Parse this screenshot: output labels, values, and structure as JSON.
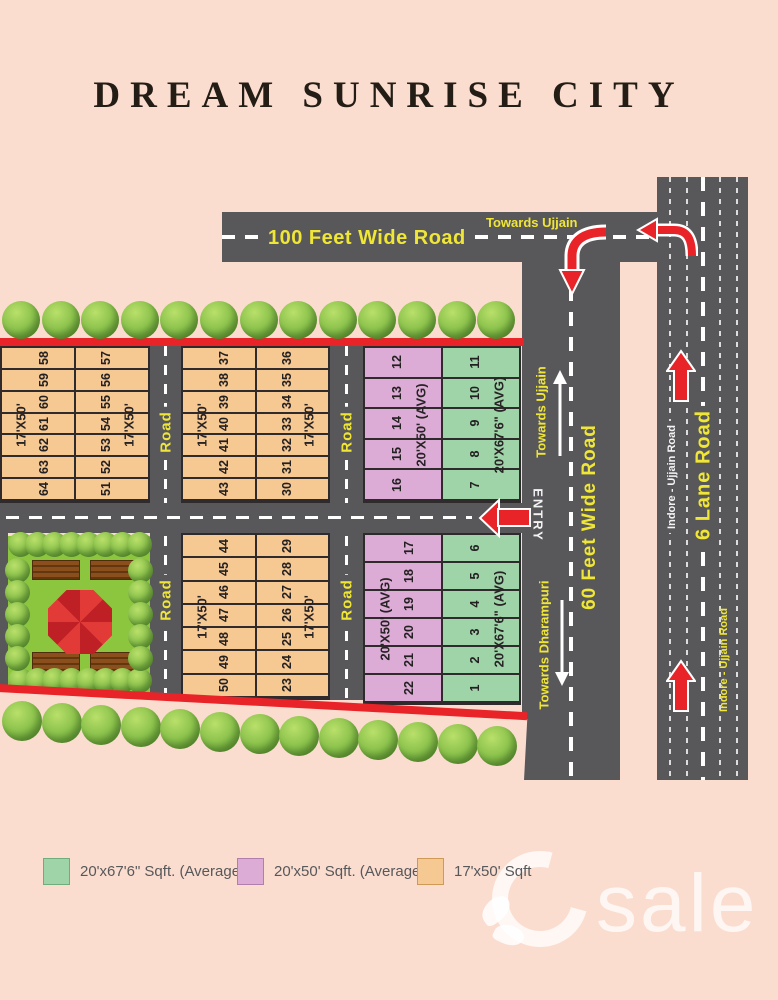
{
  "title": "DREAM SUNRISE CITY",
  "colors": {
    "background": "#fbddd0",
    "road": "#58585b",
    "accent_red": "#e92429",
    "label_yellow": "#f0e636",
    "garden_green": "#8cc63f",
    "plot_orange": "#f6c892",
    "plot_purple": "#dcacd6",
    "plot_green": "#9fd3a8"
  },
  "roads": {
    "top_road": {
      "name": "100 Feet Wide Road",
      "direction": "Towards Ujjain"
    },
    "sixty_feet_road": {
      "name": "60 Feet  Wide Road",
      "direction_up": "Towards Ujjain",
      "direction_down": "Towards Dharampuri",
      "entry": "ENTRY"
    },
    "six_lane_road": {
      "name": "6 Lane Road",
      "alias_upper": "Indore - Ujjain Road",
      "alias_lower": "Indore - Ujjain Road"
    },
    "internal_road_label": "Road"
  },
  "icons": {
    "entry_arrow": "left-block-arrow",
    "turn_down_arrow": "curved-down-arrow",
    "turn_left_arrow": "curved-left-arrow",
    "lane_up_arrow": "up-block-arrow",
    "direction_up_arrow": "thin-up-arrow",
    "direction_down_arrow": "thin-down-arrow"
  },
  "blocks": [
    {
      "id": "block-1",
      "columns": [
        {
          "color_key": "plot_orange",
          "size_label": "17'X50'",
          "label_side": "left",
          "plots": [
            "58",
            "59",
            "60",
            "61",
            "62",
            "63",
            "64"
          ]
        },
        {
          "color_key": "plot_orange",
          "size_label": "17'X50'",
          "label_side": "right",
          "plots": [
            "57",
            "56",
            "55",
            "54",
            "53",
            "52",
            "51"
          ]
        }
      ]
    },
    {
      "id": "block-2",
      "columns": [
        {
          "color_key": "plot_orange",
          "size_label": "17'X50'",
          "label_side": "left",
          "plots": [
            "37",
            "38",
            "39",
            "40",
            "41",
            "42",
            "43"
          ]
        },
        {
          "color_key": "plot_orange",
          "size_label": "17'X50'",
          "label_side": "right",
          "plots": [
            "36",
            "35",
            "34",
            "33",
            "32",
            "31",
            "30"
          ]
        }
      ]
    },
    {
      "id": "block-3",
      "columns": [
        {
          "color_key": "plot_purple",
          "size_label": "20'X50' (AVG)",
          "label_side": "right",
          "plots": [
            "12",
            "13",
            "14",
            "15",
            "16"
          ]
        },
        {
          "color_key": "plot_green",
          "size_label": "20'X67'6\" (AVG)",
          "label_side": "right",
          "plots": [
            "11",
            "10",
            "9",
            "8",
            "7"
          ]
        }
      ]
    },
    {
      "id": "block-4",
      "columns": [
        {
          "color_key": "plot_orange",
          "size_label": "17'X50'",
          "label_side": "left",
          "plots": [
            "44",
            "45",
            "46",
            "47",
            "48",
            "49",
            "50"
          ]
        },
        {
          "color_key": "plot_orange",
          "size_label": "17'X50'",
          "label_side": "right",
          "plots": [
            "29",
            "28",
            "27",
            "26",
            "25",
            "24",
            "23"
          ]
        }
      ]
    },
    {
      "id": "block-5",
      "columns": [
        {
          "color_key": "plot_purple",
          "size_label": "20'X50' (AVG)",
          "label_side": "left",
          "plots": [
            "17",
            "18",
            "19",
            "20",
            "21",
            "22"
          ]
        },
        {
          "color_key": "plot_green",
          "size_label": "20'X67'6\" (AVG)",
          "label_side": "right",
          "plots": [
            "6",
            "5",
            "4",
            "3",
            "2",
            "1"
          ]
        }
      ]
    }
  ],
  "legend": [
    {
      "color_key": "plot_green",
      "label": "20'x67'6\" Sqft. (Average)"
    },
    {
      "color_key": "plot_purple",
      "label": "20'x50' Sqft. (Average)"
    },
    {
      "color_key": "plot_orange",
      "label": "17'x50' Sqft"
    }
  ],
  "watermark": {
    "logo_letter": "G",
    "text": "sale"
  }
}
